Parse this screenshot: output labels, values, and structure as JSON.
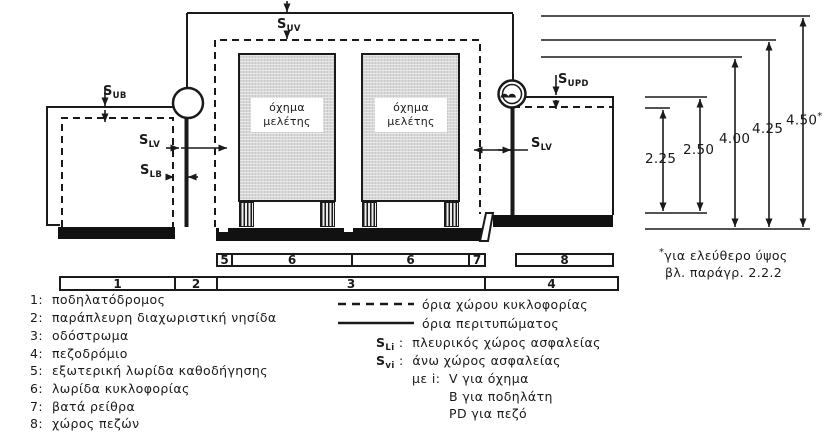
{
  "labels": {
    "suv": {
      "base": "S",
      "sub": "UV"
    },
    "sub_bike": {
      "base": "S",
      "sub": "UB"
    },
    "slv_left": {
      "base": "S",
      "sub": "LV"
    },
    "slb": {
      "base": "S",
      "sub": "LB"
    },
    "slv_right": {
      "base": "S",
      "sub": "LV"
    },
    "supd": {
      "base": "S",
      "sub": "UPD"
    }
  },
  "vehicles": {
    "left": {
      "line1": "όχημα",
      "line2": "μελέτης"
    },
    "right": {
      "line1": "όχημα",
      "line2": "μελέτης"
    }
  },
  "dimensions": [
    {
      "value": "2.25"
    },
    {
      "value": "2.50"
    },
    {
      "value": "4.00"
    },
    {
      "value": "4.25"
    },
    {
      "value": "4.50",
      "star": "*"
    }
  ],
  "zone_bars": {
    "upper": [
      {
        "label": "5"
      },
      {
        "label": "6"
      },
      {
        "label": "6"
      },
      {
        "label": "7"
      },
      {
        "label": "8"
      }
    ],
    "lower": [
      {
        "label": "1"
      },
      {
        "label": "2"
      },
      {
        "label": "3"
      },
      {
        "label": "4"
      }
    ]
  },
  "note": {
    "star": "*",
    "line1": "για ελεύθερο ύψος",
    "line2": "βλ. παράγρ. 2.2.2"
  },
  "legend": {
    "zones": [
      {
        "num": "1:",
        "text": "ποδηλατόδρομος"
      },
      {
        "num": "2:",
        "text": "παράπλευρη διαχωριστική νησίδα"
      },
      {
        "num": "3:",
        "text": "οδόστρωμα"
      },
      {
        "num": "4:",
        "text": "πεζοδρόμιο"
      },
      {
        "num": "5:",
        "text": "εξωτερική λωρίδα καθοδήγησης"
      },
      {
        "num": "6:",
        "text": "λωρίδα κυκλοφορίας"
      },
      {
        "num": "7:",
        "text": "βατά ρείθρα"
      },
      {
        "num": "8:",
        "text": "χώρος πεζών"
      }
    ],
    "lines": [
      {
        "style": "dashed",
        "text": "όρια χώρου κυκλοφορίας"
      },
      {
        "style": "solid",
        "text": "όρια περιτυπώματος"
      }
    ],
    "symbols": [
      {
        "base": "S",
        "sub": "Li",
        "sep": ":",
        "text": "πλευρικός χώρος ασφαλείας"
      },
      {
        "base": "S",
        "sub": "vi",
        "sep": ":",
        "text": "άνω χώρος ασφαλείας"
      }
    ],
    "index_note": {
      "prefix": "με i:",
      "items": [
        {
          "text": "V για όχημα"
        },
        {
          "text": "B για ποδηλάτη"
        },
        {
          "text": "PD για πεζό"
        }
      ]
    }
  },
  "colors": {
    "ink": "#1a1a1a",
    "vehicle_fill": "#d8d8d8",
    "background": "#ffffff"
  }
}
